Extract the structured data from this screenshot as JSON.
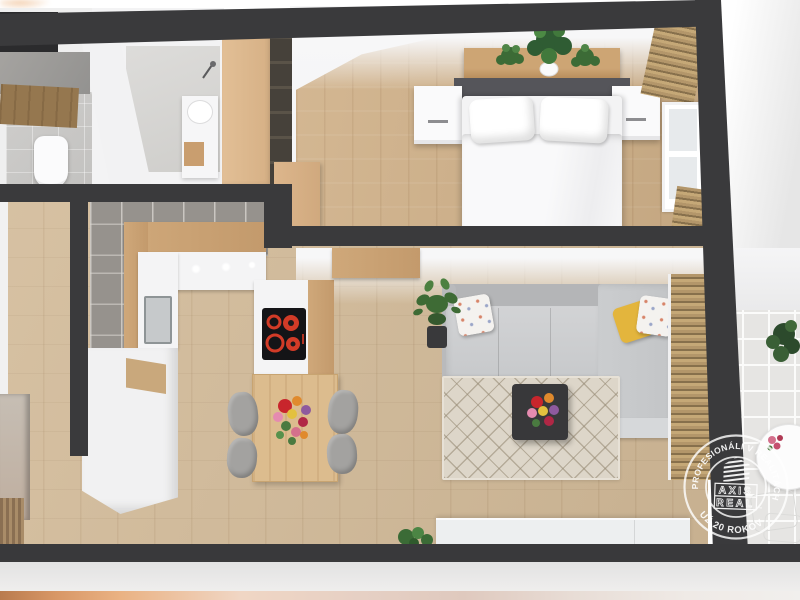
{
  "watermark": {
    "arc_top_text": "PROFESIONÁLI V REALITÁCH",
    "arc_bottom_text": "UŽ 20 ROKOV",
    "brand_word_1": "AXIS",
    "brand_word_2": "REAL",
    "trademark_symbol": "™",
    "logo_icon": "axis-real-building-icon"
  },
  "scene": {
    "type": "3d-floor-plan-render",
    "rooms": [
      "entry-hallway",
      "wc",
      "bathroom",
      "bedroom",
      "kitchen-dining",
      "living-room",
      "balcony"
    ],
    "details": {
      "hob_burners": 4,
      "dining_chairs": 4,
      "headboard_plants": 3,
      "bed_pillows": 2,
      "sofa_shape": "L-corner"
    }
  },
  "palette": {
    "wall_dark": "#3a3a3c",
    "wood_floor": "#d2ba98",
    "bedroom_wood": "#d0b189",
    "kitchen_tile_gray": "#96928d",
    "wardrobe_tan": "#dcb88e",
    "sofa_gray": "#c9cacc",
    "rug_beige": "#ddd6c9",
    "hob_burner_red": "#d23b27",
    "yellow_pillow": "#e3b53d",
    "balcony_tile": "#e6e5e3",
    "accent_copper": "#d89766",
    "badge_white": "#ffffff"
  }
}
